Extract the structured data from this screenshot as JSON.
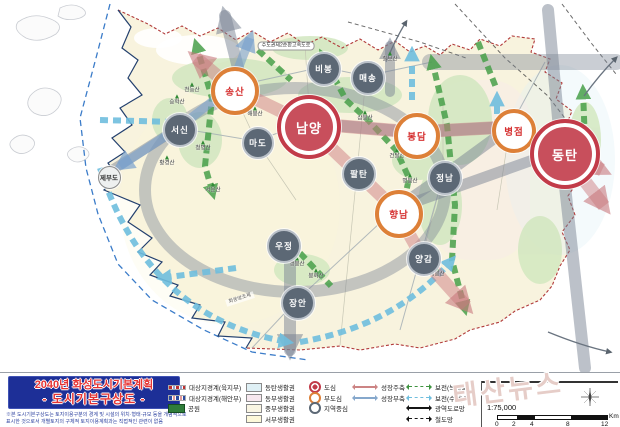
{
  "title_box": {
    "line1": "2040년 화성도시기본계획",
    "line2": "- 도시기본구상도 -",
    "disclaimer1": "※본 도시기본구상도는 토지이용구분의 경계 및 시설의 위치·형태·규모 등을 개념적으로",
    "disclaimer2": "표시한 것으로서 개별토지의 구체적 토지이용계획과는 직접적인 관련이 없음"
  },
  "legend": {
    "col_boundary": [
      {
        "label": "대상지경계(육지부)",
        "sym": "sym-dash-red"
      },
      {
        "label": "대상지경계(해안부)",
        "sym": "sym-dash-blue"
      },
      {
        "label": "공원",
        "sym": "sym-park"
      }
    ],
    "col_zone": [
      {
        "label": "동탄생활권",
        "color": "#dff0f5"
      },
      {
        "label": "동부생활권",
        "color": "#f7e8ef"
      },
      {
        "label": "중부생활권",
        "color": "#f9f5e3"
      },
      {
        "label": "서부생활권",
        "color": "#fdf8d9"
      }
    ],
    "col_center": [
      {
        "label": "도심",
        "sym": "c-dosim"
      },
      {
        "label": "부도심",
        "sym": "c-budosim"
      },
      {
        "label": "지역중심",
        "sym": "c-region"
      }
    ],
    "col_axis1": [
      {
        "label": "성장주축",
        "sym": "ax-pink",
        "dashed": false
      },
      {
        "label": "성장부축",
        "sym": "ax-blue",
        "dashed": false
      }
    ],
    "col_axis2": [
      {
        "label": "보전(녹지축)",
        "sym": "ax-green-d",
        "dashed": true
      },
      {
        "label": "보전(수변)축",
        "sym": "ax-cyan-d",
        "dashed": true
      },
      {
        "label": "광역도로망",
        "sym": "ax-black",
        "dashed": false
      },
      {
        "label": "철도망",
        "sym": "ax-black-d",
        "dashed": true
      }
    ]
  },
  "scale": {
    "ratio": "1:75,000",
    "ticks": [
      "0",
      "2",
      "4",
      "8",
      "12"
    ],
    "unit": "Km"
  },
  "watermark": "태산뉴스",
  "colors": {
    "dosim": "#c23b49",
    "budosim": "#dd8038",
    "region": "#5c6875",
    "growth_primary": "#cc8484",
    "growth_secondary": "#86a8cc",
    "green_axis": "#3f9440",
    "water_axis": "#6fbede",
    "land": "#f8f3de"
  },
  "map": {
    "cities": [
      {
        "label": "남양",
        "x": 305,
        "y": 123,
        "d": 56,
        "type": "dosim"
      },
      {
        "label": "동탄",
        "x": 561,
        "y": 150,
        "d": 62,
        "type": "dosim"
      },
      {
        "label": "송산",
        "x": 231,
        "y": 87,
        "d": 40,
        "type": "budosim"
      },
      {
        "label": "봉담",
        "x": 413,
        "y": 132,
        "d": 38,
        "type": "budosim"
      },
      {
        "label": "병점",
        "x": 510,
        "y": 127,
        "d": 36,
        "type": "budosim"
      },
      {
        "label": "향남",
        "x": 395,
        "y": 210,
        "d": 40,
        "type": "budosim"
      },
      {
        "label": "서신",
        "x": 178,
        "y": 128,
        "d": 30,
        "type": "region"
      },
      {
        "label": "마도",
        "x": 256,
        "y": 141,
        "d": 28,
        "type": "region"
      },
      {
        "label": "비봉",
        "x": 322,
        "y": 67,
        "d": 30,
        "type": "region"
      },
      {
        "label": "매송",
        "x": 366,
        "y": 76,
        "d": 30,
        "type": "region"
      },
      {
        "label": "팔탄",
        "x": 357,
        "y": 172,
        "d": 30,
        "type": "region"
      },
      {
        "label": "정남",
        "x": 443,
        "y": 176,
        "d": 30,
        "type": "region"
      },
      {
        "label": "양감",
        "x": 422,
        "y": 257,
        "d": 30,
        "type": "region"
      },
      {
        "label": "우정",
        "x": 282,
        "y": 244,
        "d": 30,
        "type": "region"
      },
      {
        "label": "장안",
        "x": 296,
        "y": 301,
        "d": 30,
        "type": "region"
      },
      {
        "label": "제부도",
        "x": 108,
        "y": 176,
        "d": 21,
        "type": "minor"
      }
    ],
    "mountains": [
      {
        "name": "천등산",
        "x": 192,
        "y": 88
      },
      {
        "name": "승학산",
        "x": 177,
        "y": 100
      },
      {
        "name": "해봉산",
        "x": 255,
        "y": 112
      },
      {
        "name": "삼봉산",
        "x": 365,
        "y": 116
      },
      {
        "name": "청명산",
        "x": 203,
        "y": 146
      },
      {
        "name": "황경산",
        "x": 167,
        "y": 161
      },
      {
        "name": "서운산",
        "x": 213,
        "y": 188
      },
      {
        "name": "칠보산",
        "x": 390,
        "y": 57
      },
      {
        "name": "건달산",
        "x": 397,
        "y": 154
      },
      {
        "name": "명봉산",
        "x": 410,
        "y": 179
      },
      {
        "name": "무봉산",
        "x": 582,
        "y": 129
      },
      {
        "name": "앵봉산",
        "x": 297,
        "y": 262
      },
      {
        "name": "봉화산",
        "x": 316,
        "y": 274
      },
      {
        "name": "태봉산",
        "x": 437,
        "y": 272
      }
    ],
    "labels": [
      {
        "text": "수도권제2순환고속도로",
        "x": 286,
        "y": 46,
        "kind": "road"
      },
      {
        "text": "화옹방조제",
        "x": 240,
        "y": 299,
        "kind": "plain"
      }
    ]
  }
}
